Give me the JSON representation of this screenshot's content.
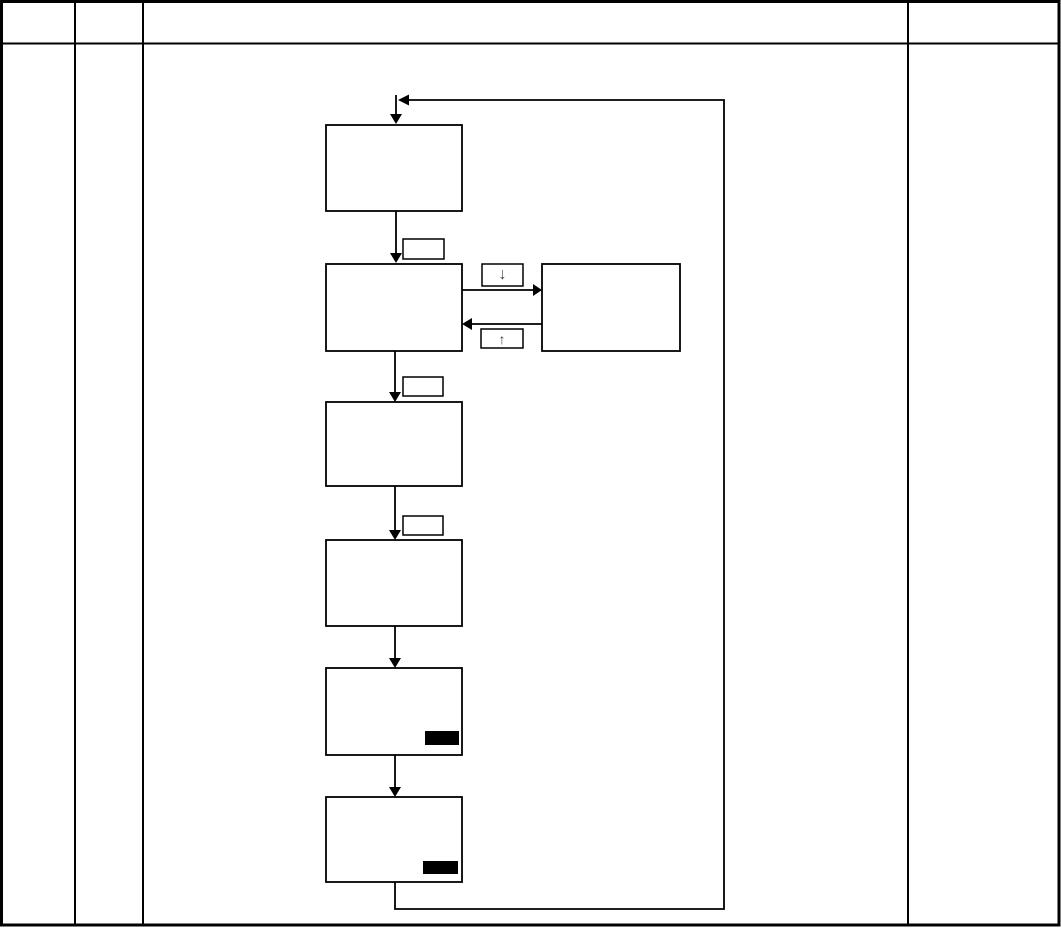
{
  "page": {
    "background": "#ffffff",
    "line_color": "#000000"
  },
  "flowchart": {
    "down_transfer_label": "↓",
    "up_transfer_label": "↑"
  }
}
